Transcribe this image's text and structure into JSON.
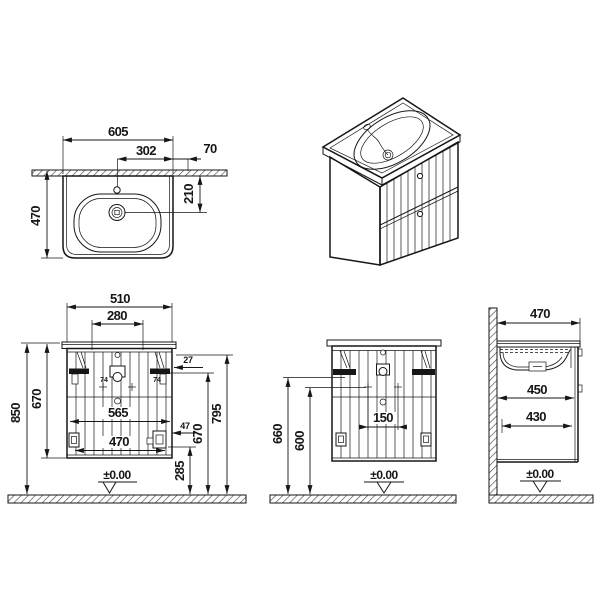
{
  "drawing": {
    "subject": "wall-hung washbasin vanity unit technical drawing",
    "colors": {
      "line": "#161616",
      "background": "#ffffff"
    },
    "views": {
      "basin_top": {
        "d605": "605",
        "d302": "302",
        "d70": "70",
        "d470": "470",
        "d210": "210"
      },
      "front": {
        "d510": "510",
        "d280": "280",
        "d850": "850",
        "d670_left": "670",
        "d565": "565",
        "d470": "470",
        "d27": "27",
        "d47": "47",
        "d74_left": "74",
        "d74_right": "74",
        "d670_right": "670",
        "d795": "795",
        "d285": "285",
        "datum": "±0.00"
      },
      "rear": {
        "d660": "660",
        "d600": "600",
        "d150": "150",
        "datum": "±0.00"
      },
      "side": {
        "d470": "470",
        "d450": "450",
        "d430": "430",
        "datum": "±0.00"
      }
    }
  }
}
